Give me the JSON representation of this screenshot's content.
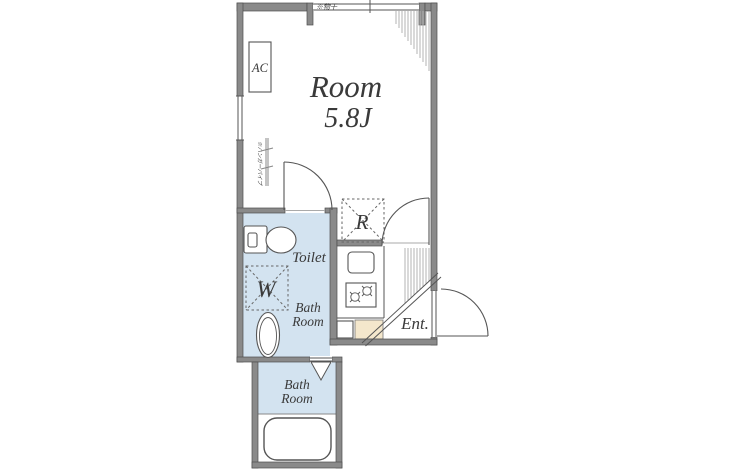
{
  "plan": {
    "room": {
      "name": "Room",
      "size": "5.8J"
    },
    "labels": {
      "ac": "AC",
      "fridge": "R",
      "washer": "W",
      "toilet": "Toilet",
      "entrance": "Ent.",
      "bath_line1": "Bath",
      "bath_line2": "Room",
      "laundry_note": "※物干",
      "hanger_note": "※ハンガーパイプ"
    }
  },
  "colors": {
    "wall_gray": "#8a8a8a",
    "wall_edge": "#4f4f4f",
    "floor_blue": "#d3e3f0",
    "genkan_beige": "#f4e7cc",
    "line": "#555555",
    "text": "#3a3a3a",
    "background": "#ffffff"
  }
}
